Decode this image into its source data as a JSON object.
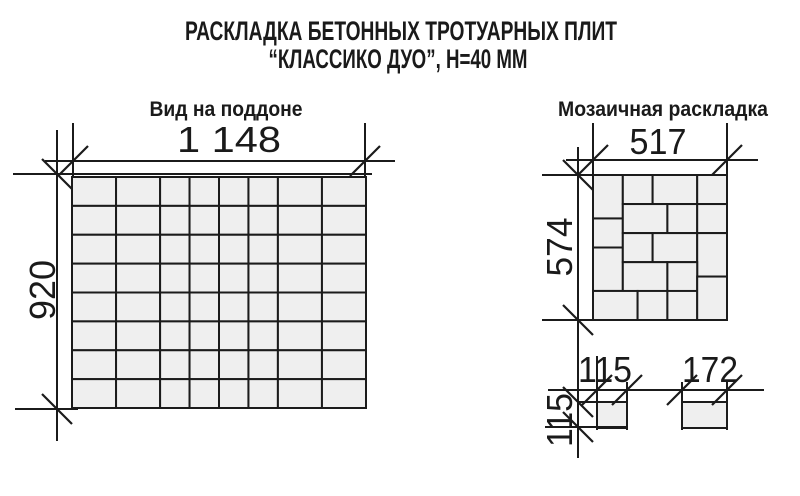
{
  "title": {
    "line1": "РАСКЛАДКА БЕТОННЫХ ТРОТУАРНЫХ ПЛИТ",
    "line2": "“КЛАССИКО ДУО”, Н=40 ММ"
  },
  "colors": {
    "background": "#ffffff",
    "tile_fill": "#efefef",
    "line": "#1b1b1b",
    "text": "#1a1a1a"
  },
  "pallet": {
    "label": "Вид на поддоне",
    "width_label": "1 148",
    "height_label": "920",
    "grid": {
      "total_width_mm": 1148,
      "total_height_mm": 920,
      "cols_mm": [
        172,
        172,
        115,
        115,
        115,
        115,
        172,
        172
      ],
      "rows_mm": [
        115,
        115,
        115,
        115,
        115,
        115,
        115,
        115
      ]
    }
  },
  "mosaic": {
    "label": "Мозаичная раскладка",
    "width_label": "517",
    "height_label": "574",
    "total_width_mm": 517,
    "total_height_mm": 574,
    "tiles_mm": [
      {
        "x": 0,
        "y": 0,
        "w": 115,
        "h": 172
      },
      {
        "x": 115,
        "y": 0,
        "w": 115,
        "h": 115
      },
      {
        "x": 230,
        "y": 0,
        "w": 172,
        "h": 115
      },
      {
        "x": 402,
        "y": 0,
        "w": 115,
        "h": 115
      },
      {
        "x": 0,
        "y": 172,
        "w": 115,
        "h": 115
      },
      {
        "x": 115,
        "y": 115,
        "w": 172,
        "h": 115
      },
      {
        "x": 287,
        "y": 115,
        "w": 115,
        "h": 115
      },
      {
        "x": 402,
        "y": 115,
        "w": 115,
        "h": 115
      },
      {
        "x": 0,
        "y": 287,
        "w": 115,
        "h": 172
      },
      {
        "x": 115,
        "y": 230,
        "w": 115,
        "h": 115
      },
      {
        "x": 230,
        "y": 230,
        "w": 172,
        "h": 115
      },
      {
        "x": 402,
        "y": 230,
        "w": 115,
        "h": 172
      },
      {
        "x": 115,
        "y": 345,
        "w": 172,
        "h": 115
      },
      {
        "x": 287,
        "y": 345,
        "w": 115,
        "h": 115
      },
      {
        "x": 0,
        "y": 459,
        "w": 172,
        "h": 115
      },
      {
        "x": 172,
        "y": 459,
        "w": 115,
        "h": 115
      },
      {
        "x": 287,
        "y": 459,
        "w": 115,
        "h": 115
      },
      {
        "x": 402,
        "y": 402,
        "w": 115,
        "h": 172
      }
    ]
  },
  "single_tiles": {
    "square": {
      "width_label": "115",
      "height_label": "115",
      "w_mm": 115,
      "h_mm": 115
    },
    "rectangle": {
      "width_label": "172",
      "w_mm": 172,
      "h_mm": 115
    }
  }
}
